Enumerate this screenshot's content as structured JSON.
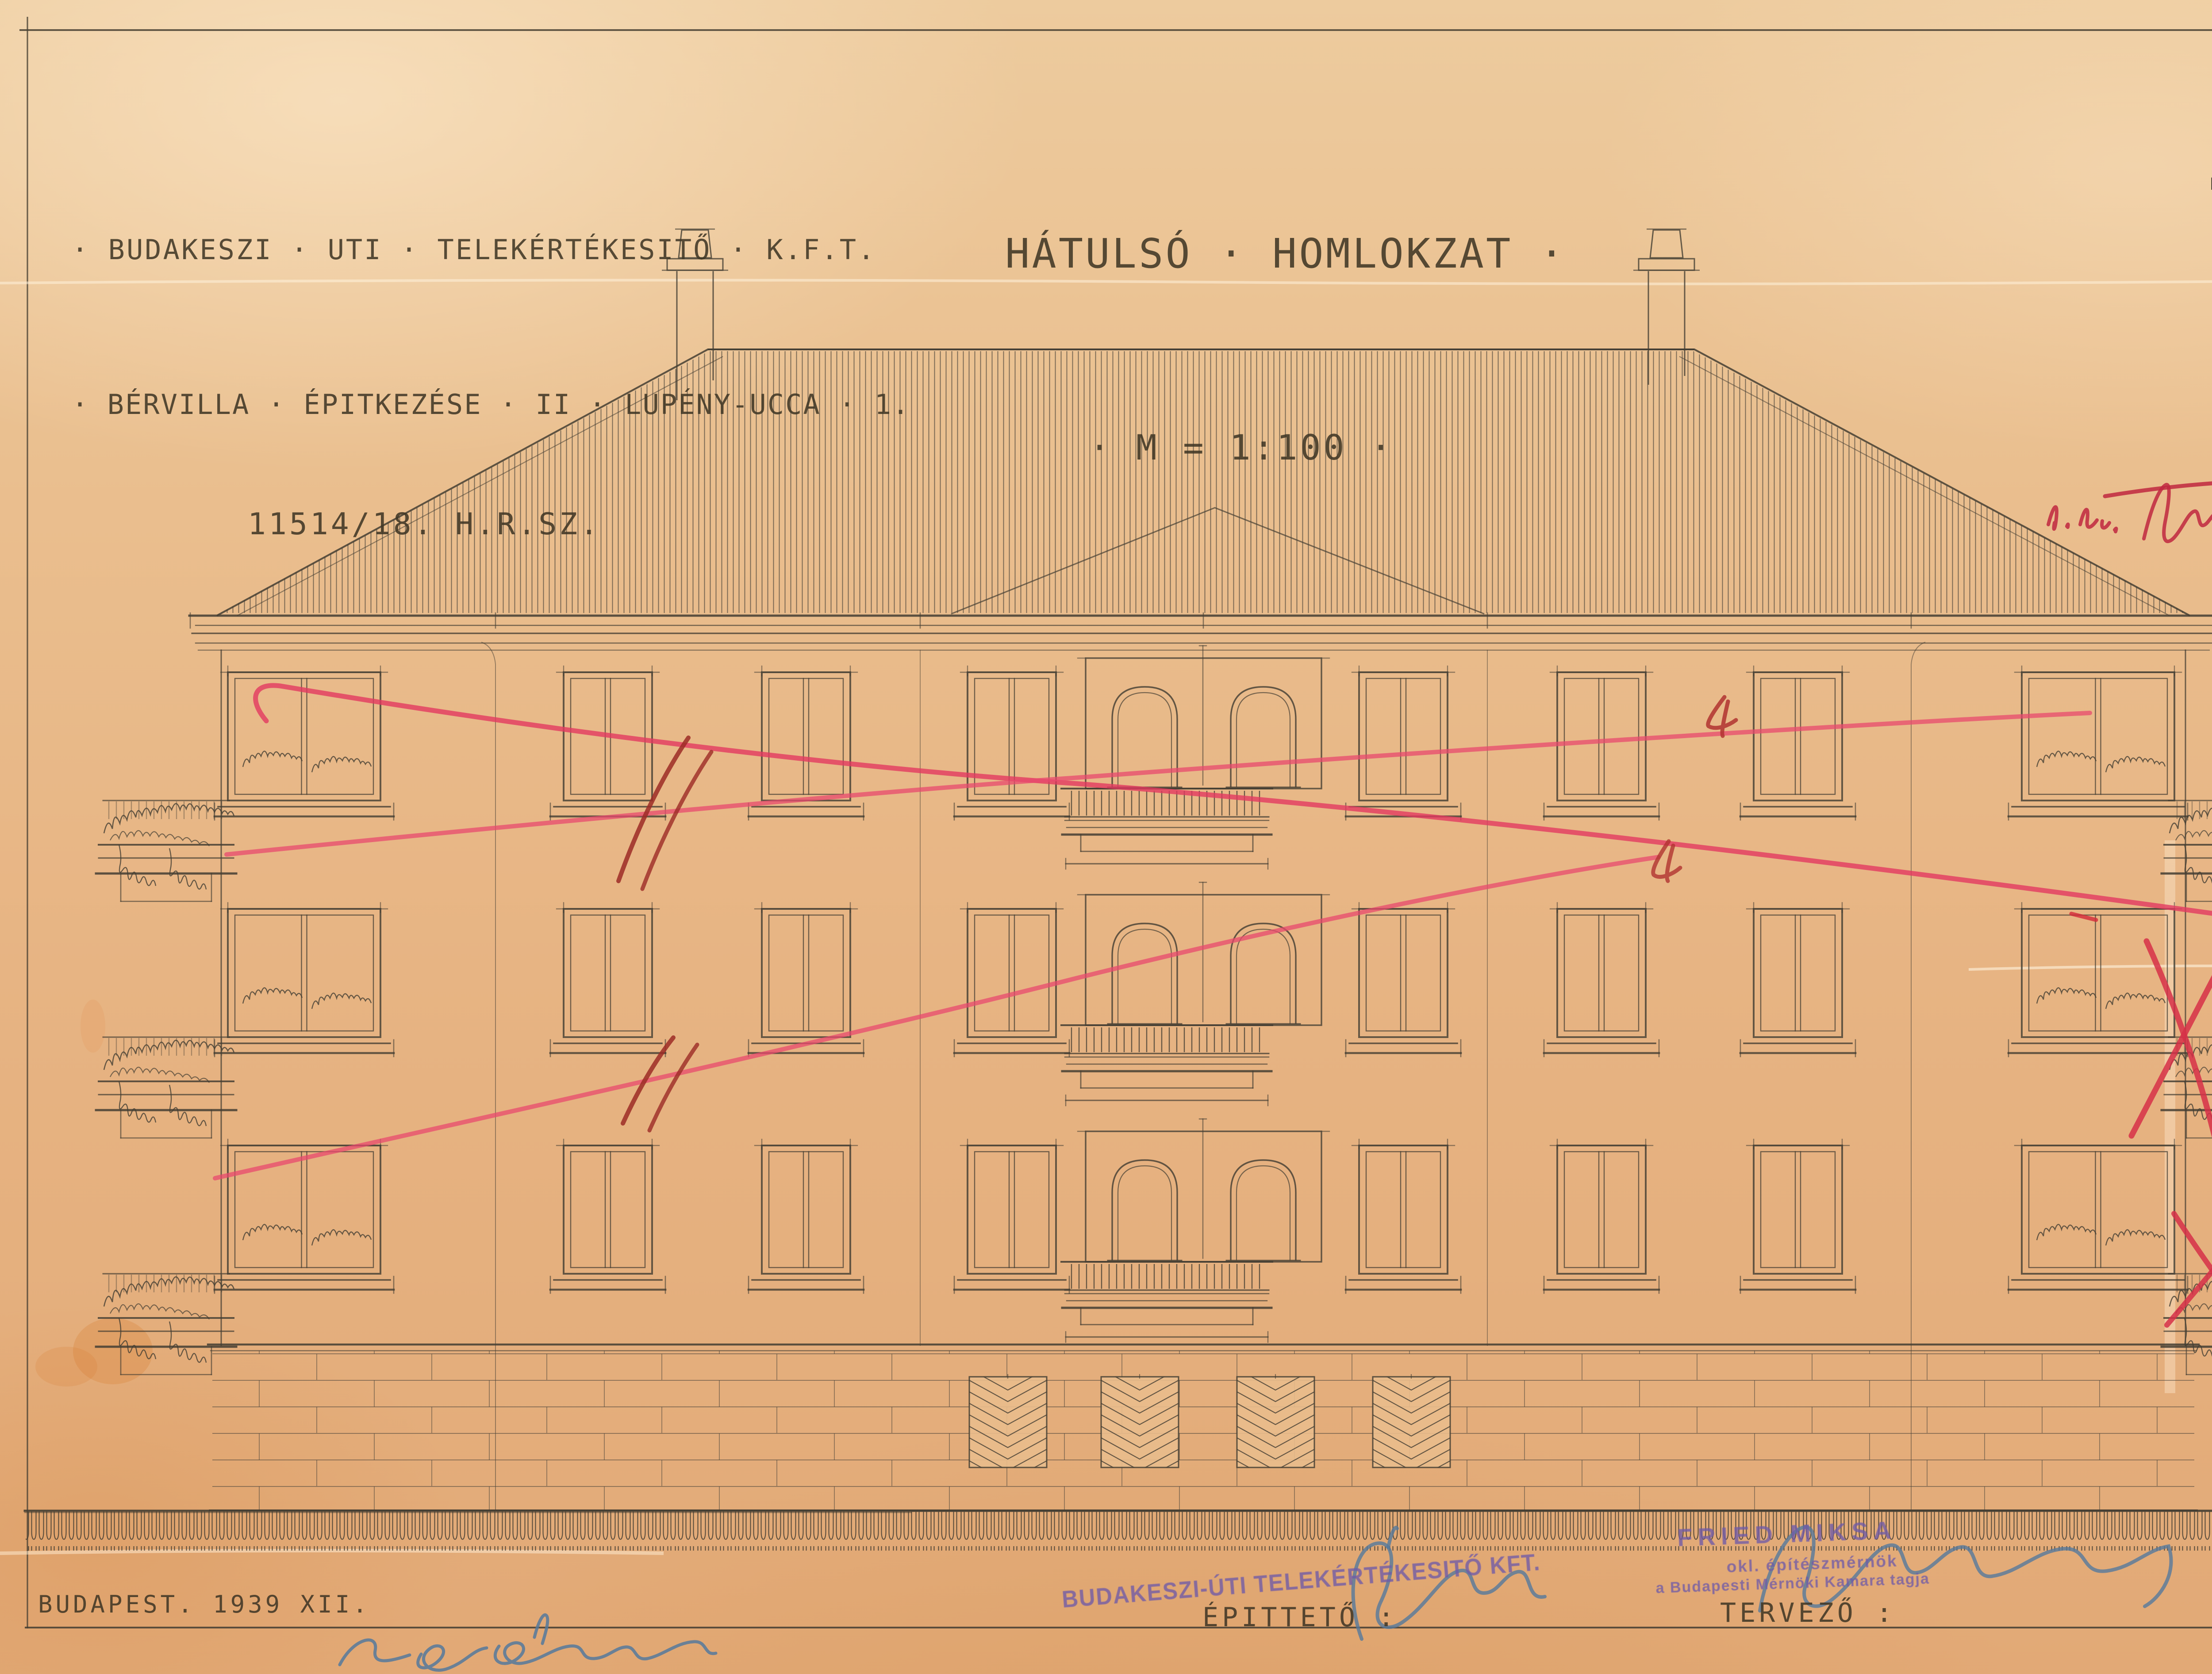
{
  "titles": {
    "project1": "· BUDAKESZI · UTI · TELEKÉRTÉKESITŐ · K.F.T.",
    "project2": "· BÉRVILLA · ÉPITKEZÉSE · II · LUPÉNY-UCCA · 1.",
    "lot_number": "11514/18. H.R.SZ.",
    "drawing_title": "HÁTULSÓ · HOMLOKZAT ·",
    "drawing_scale": "· M = 1:100 ·"
  },
  "footer": {
    "date_place": "BUDAPEST. 1939 XII.",
    "client_label": "ÉPITTETŐ :",
    "designer_label": "TERVEZŐ :"
  },
  "stamps": {
    "company": "BUDAKESZI-ÚTI TELEKÉRTÉKESITŐ KFT.",
    "architect_name": "FRIED  MIKSA",
    "architect_title": "okl. építészmérnök",
    "architect_membership": "a Budapesti Mérnöki Kamara tagja"
  },
  "annotations": {
    "red_note": "u. jáv."
  },
  "archive": {
    "name": "Budapest Főváros Levéltára"
  },
  "colors": {
    "paper": "#e9bc8c",
    "ink": "#443e33",
    "red_pencil": "#e23a60",
    "dark_red": "#9c2b26",
    "stamp_purple": "#6e5aa8",
    "signature_blue": "#55799c"
  }
}
